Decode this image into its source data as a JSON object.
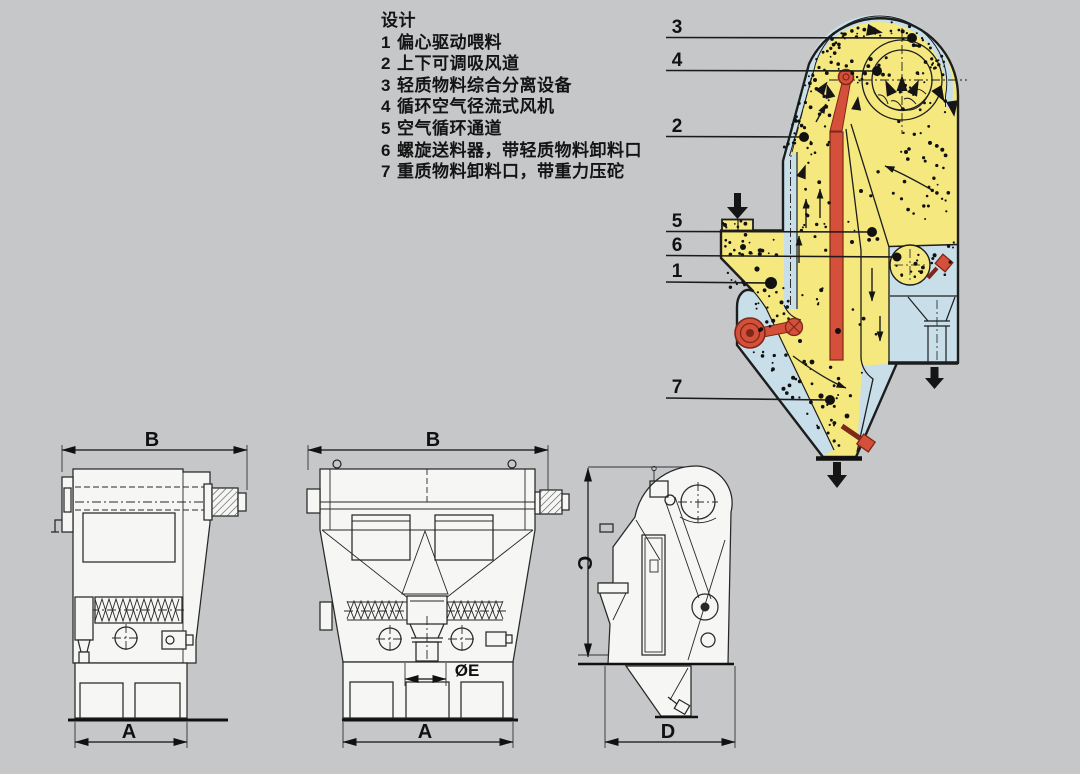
{
  "page": {
    "background": "#c5c7c9"
  },
  "legend": {
    "title": "设计",
    "items": [
      {
        "num": "1",
        "label": "偏心驱动喂料"
      },
      {
        "num": "2",
        "label": "上下可调吸风道"
      },
      {
        "num": "3",
        "label": "轻质物料综合分离设备"
      },
      {
        "num": "4",
        "label": "循环空气径流式风机"
      },
      {
        "num": "5",
        "label": "空气循环通道"
      },
      {
        "num": "6",
        "label": "螺旋送料器，带轻质物料卸料口"
      },
      {
        "num": "7",
        "label": "重质物料卸料口，带重力压砣"
      }
    ]
  },
  "schematic": {
    "colors": {
      "body": "#f5e87e",
      "air_channel": "#c8dfea",
      "mechanism_red": "#d5503a",
      "mechanism_dark": "#7e2817",
      "outline": "#1d1d1d"
    },
    "callouts": {
      "n3": "3",
      "n4": "4",
      "n2": "2",
      "n5": "5",
      "n6": "6",
      "n1": "1",
      "n7": "7"
    }
  },
  "views": {
    "left": {
      "width_label": "B",
      "base_label": "A"
    },
    "front": {
      "width_label": "B",
      "base_label": "A",
      "outlet_label": "ØE"
    },
    "side": {
      "height_label": "C",
      "depth_label": "D"
    }
  }
}
